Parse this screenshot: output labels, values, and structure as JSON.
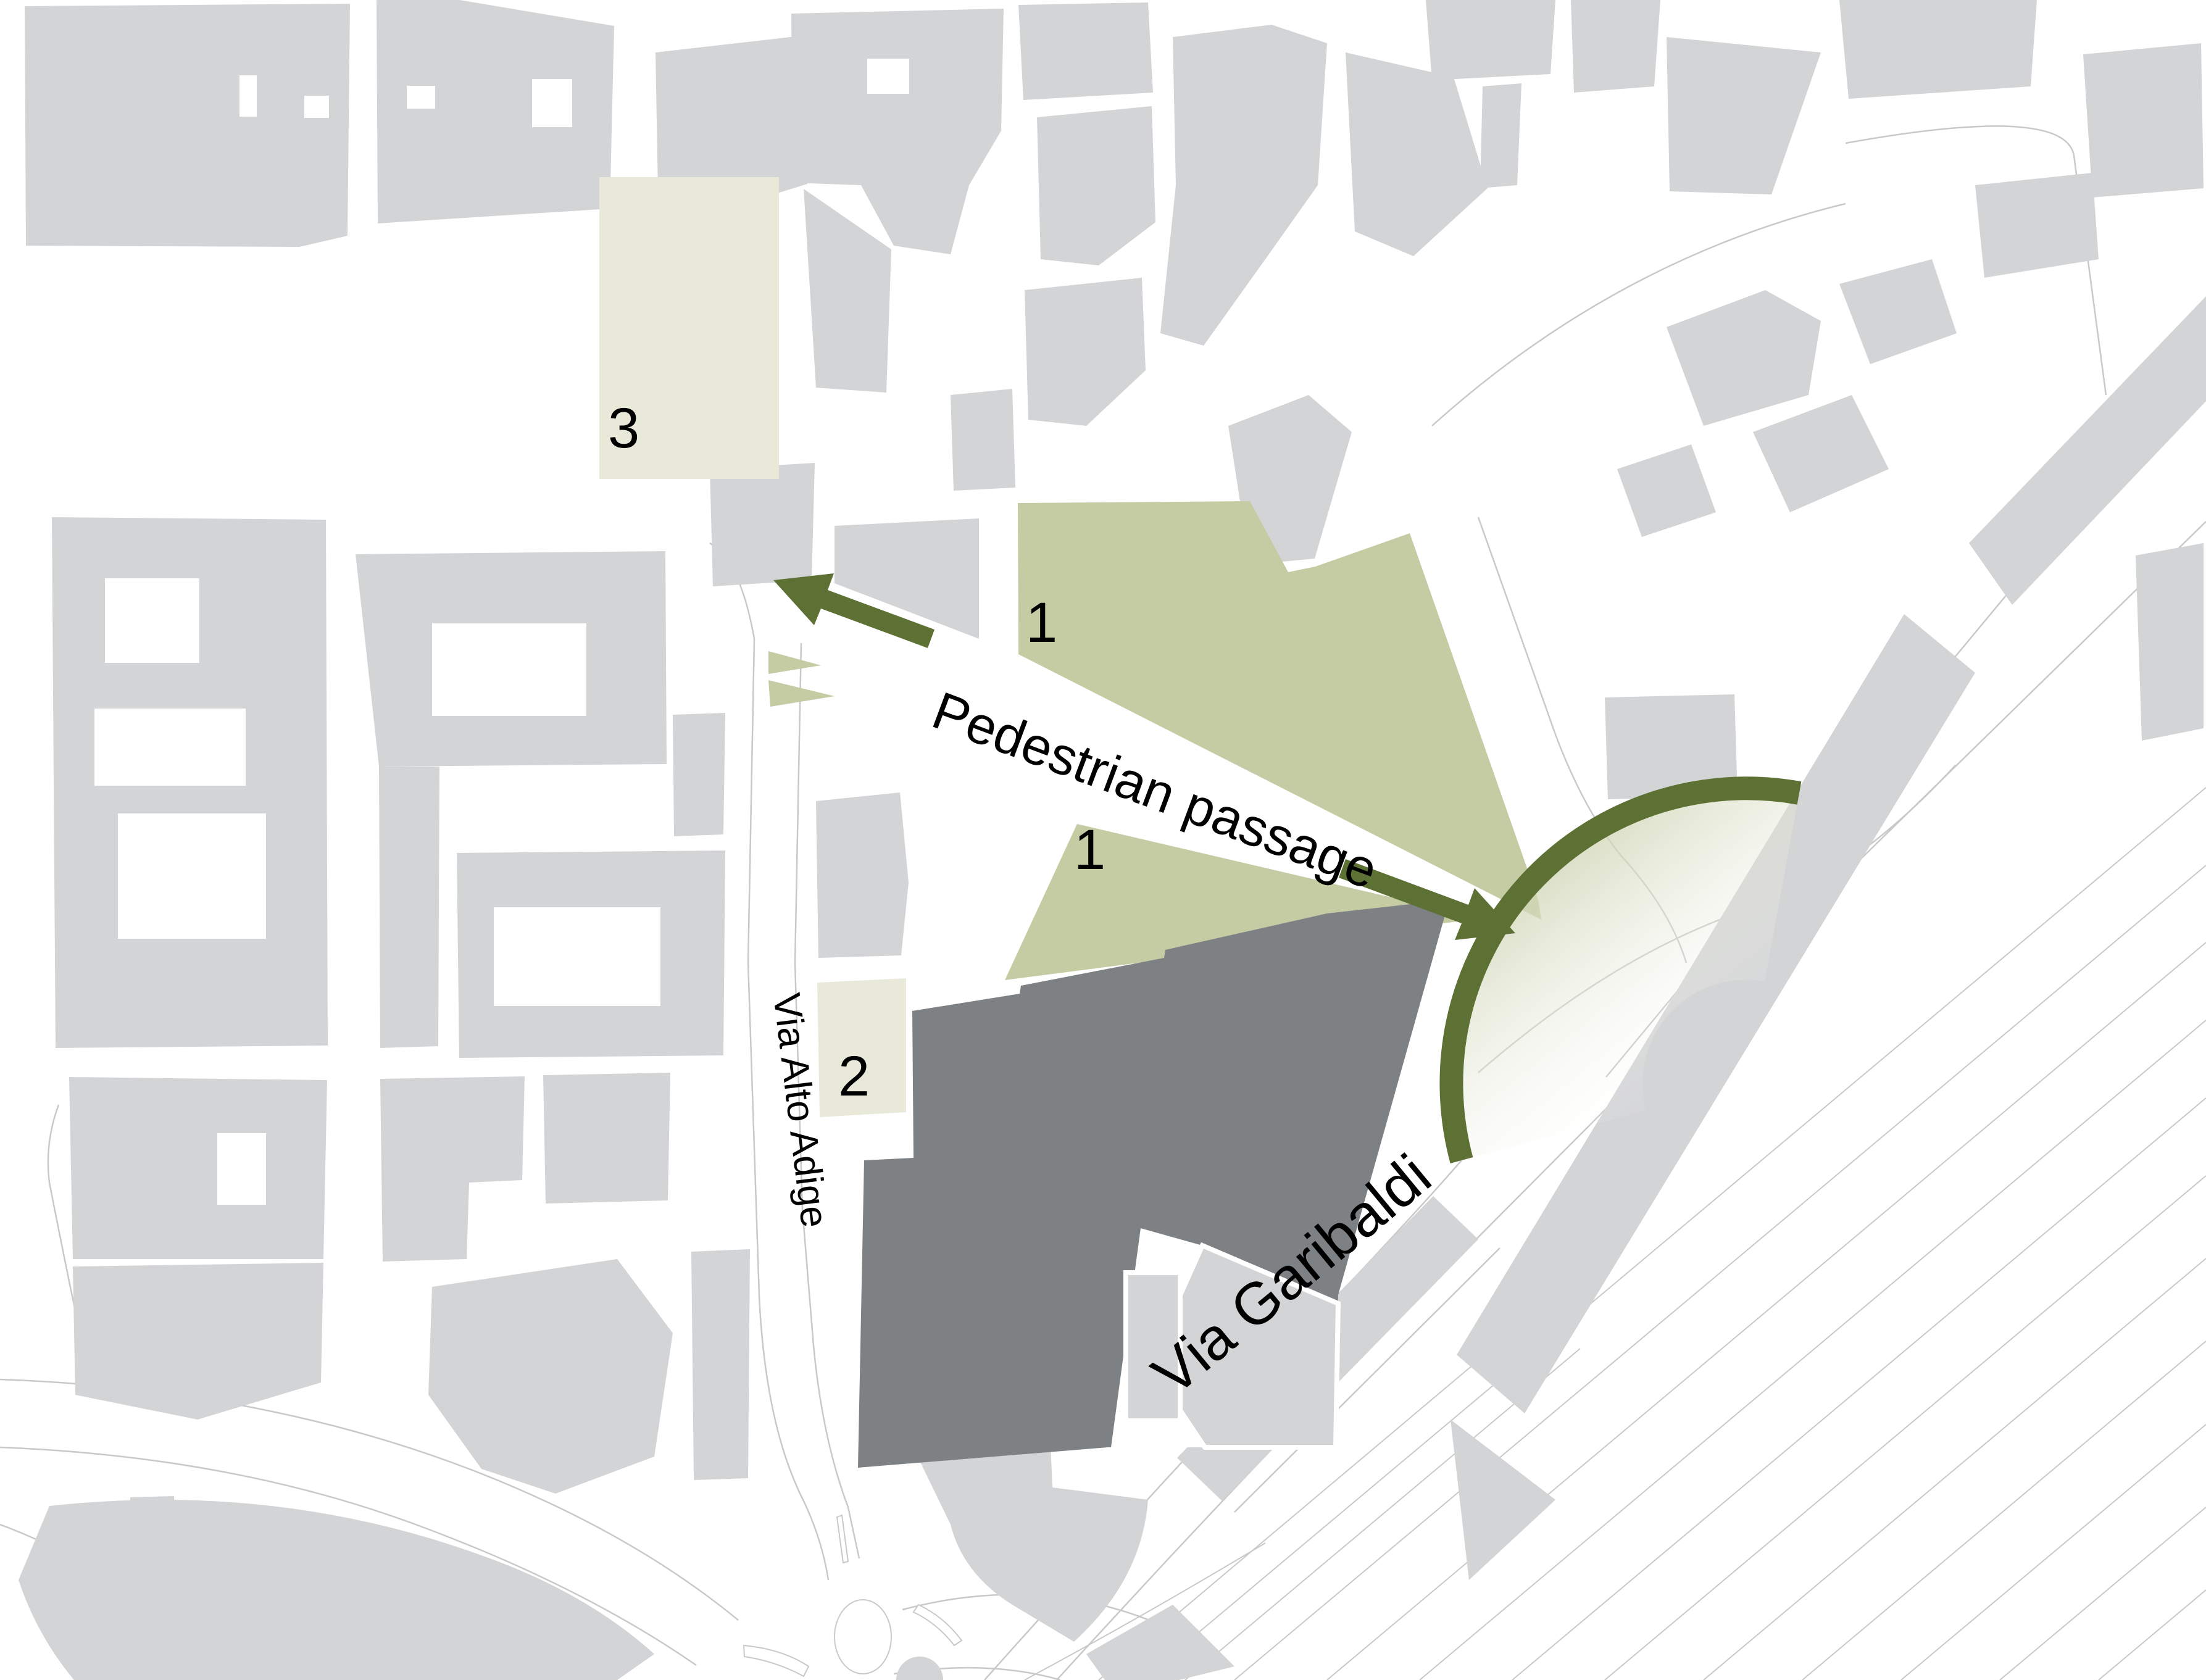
{
  "map": {
    "kind": "urban site plan",
    "streets": {
      "alto_adige": "Via Alto Adige",
      "garibaldi": "Via Garibaldi"
    },
    "annotations": {
      "passage_label": "Pedestrian passage",
      "markers": {
        "area1_upper": "1",
        "area1_lower": "1",
        "area2": "2",
        "area3": "3"
      }
    },
    "colors": {
      "background": "#ffffff",
      "building": "#d3d4d6",
      "site_building": "#7e8184",
      "green_area": "#c5cba3",
      "pale_area": "#e9e9da",
      "olive_accent": "#5d7134",
      "road_line": "#c9c9c9",
      "label_text": "#000000"
    }
  }
}
